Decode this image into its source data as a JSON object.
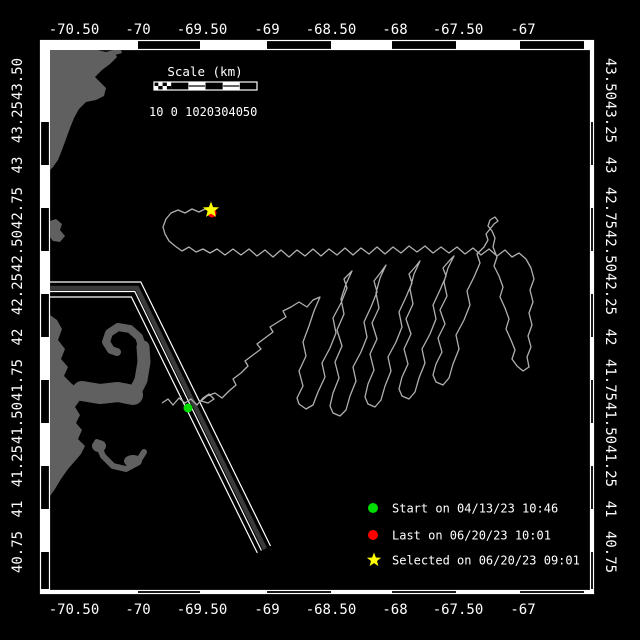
{
  "colors": {
    "background": "#000000",
    "frame": "#ffffff",
    "land": "#606060",
    "lane_fill": "#3a3a3a",
    "lane_edge": "#ffffff",
    "track": "#b0b0b0",
    "start": "#00dd00",
    "last": "#ff0000",
    "selected": "#ffff00"
  },
  "axes": {
    "top_labels": [
      {
        "t": "-70.50",
        "x": 74
      },
      {
        "t": "-70",
        "x": 138
      },
      {
        "t": "-69.50",
        "x": 202
      },
      {
        "t": "-69",
        "x": 267
      },
      {
        "t": "-68.50",
        "x": 331
      },
      {
        "t": "-68",
        "x": 395
      },
      {
        "t": "-67.50",
        "x": 458
      },
      {
        "t": "-67",
        "x": 523
      }
    ],
    "bottom_labels": [
      {
        "t": "-70.50",
        "x": 74
      },
      {
        "t": "-70",
        "x": 138
      },
      {
        "t": "-69.50",
        "x": 202
      },
      {
        "t": "-69",
        "x": 267
      },
      {
        "t": "-68.50",
        "x": 331
      },
      {
        "t": "-68",
        "x": 395
      },
      {
        "t": "-67.50",
        "x": 458
      },
      {
        "t": "-67",
        "x": 523
      }
    ],
    "left_labels": [
      {
        "t": "43.50",
        "y": 79
      },
      {
        "t": "43.25",
        "y": 122
      },
      {
        "t": "43",
        "y": 165
      },
      {
        "t": "42.75",
        "y": 208
      },
      {
        "t": "42.50",
        "y": 251
      },
      {
        "t": "42.25",
        "y": 294
      },
      {
        "t": "42",
        "y": 337
      },
      {
        "t": "41.75",
        "y": 380
      },
      {
        "t": "41.50",
        "y": 423
      },
      {
        "t": "41.25",
        "y": 466
      },
      {
        "t": "41",
        "y": 509
      },
      {
        "t": "40.75",
        "y": 552
      }
    ],
    "right_labels": [
      {
        "t": "43.50",
        "y": 79
      },
      {
        "t": "43.25",
        "y": 122
      },
      {
        "t": "43",
        "y": 165
      },
      {
        "t": "42.75",
        "y": 208
      },
      {
        "t": "42.50",
        "y": 251
      },
      {
        "t": "42.25",
        "y": 294
      },
      {
        "t": "42",
        "y": 337
      },
      {
        "t": "41.75",
        "y": 380
      },
      {
        "t": "41.50",
        "y": 423
      },
      {
        "t": "41.25",
        "y": 466
      },
      {
        "t": "41",
        "y": 509
      },
      {
        "t": "40.75",
        "y": 552
      }
    ],
    "lon_bars": [
      {
        "x": 138,
        "w": 62
      },
      {
        "x": 267,
        "w": 64
      },
      {
        "x": 392,
        "w": 64
      },
      {
        "x": 520,
        "w": 64
      }
    ],
    "lat_bars": [
      {
        "y": 122,
        "h": 43
      },
      {
        "y": 208,
        "h": 43
      },
      {
        "y": 294,
        "h": 43
      },
      {
        "y": 380,
        "h": 43
      },
      {
        "y": 466,
        "h": 43
      },
      {
        "y": 552,
        "h": 38
      }
    ]
  },
  "scalebar": {
    "title": "Scale (km)",
    "title_x": 205,
    "title_y": 76,
    "bar": {
      "x": 154,
      "y": 82,
      "w": 103,
      "h": 8
    },
    "segment_fills": [
      "checker",
      "black",
      "white",
      "black",
      "white",
      "black"
    ],
    "tick_labels": "10 0 1020304050",
    "labels_x": 149,
    "labels_y": 116
  },
  "legend": {
    "marker_x": 373,
    "text_x": 392,
    "items": [
      {
        "shape": "circle",
        "color": "#00dd00",
        "y": 508,
        "label": "Start on 04/13/23 10:46"
      },
      {
        "shape": "circle",
        "color": "#ff0000",
        "y": 535,
        "label": "Last on 06/20/23 10:01"
      },
      {
        "shape": "star",
        "color": "#ffff00",
        "y": 560,
        "label": "Selected on 06/20/23 09:01"
      }
    ]
  },
  "markers": {
    "start": {
      "x": 188,
      "y": 408,
      "r": 4.5
    },
    "last": {
      "x": 212,
      "y": 213,
      "r": 4.5
    },
    "selected": {
      "x": 211,
      "y": 210,
      "r": 8.5
    }
  },
  "land": {
    "polys": [
      [
        [
          50,
          50
        ],
        [
          97,
          50
        ],
        [
          106,
          52
        ],
        [
          113,
          50
        ],
        [
          117,
          57
        ],
        [
          110,
          64
        ],
        [
          102,
          70
        ],
        [
          95,
          77
        ],
        [
          100,
          82
        ],
        [
          106,
          88
        ],
        [
          104,
          96
        ],
        [
          96,
          100
        ],
        [
          86,
          102
        ],
        [
          79,
          109
        ],
        [
          74,
          118
        ],
        [
          70,
          128
        ],
        [
          66,
          139
        ],
        [
          62,
          150
        ],
        [
          58,
          160
        ],
        [
          53,
          167
        ],
        [
          50,
          170
        ]
      ],
      [
        [
          113,
          50
        ],
        [
          120,
          48
        ],
        [
          122,
          53
        ],
        [
          115,
          55
        ]
      ],
      [
        [
          50,
          221
        ],
        [
          56,
          219
        ],
        [
          62,
          224
        ],
        [
          60,
          230
        ],
        [
          65,
          236
        ],
        [
          60,
          242
        ],
        [
          53,
          241
        ],
        [
          50,
          237
        ]
      ],
      [
        [
          50,
          315
        ],
        [
          57,
          320
        ],
        [
          62,
          329
        ],
        [
          58,
          340
        ],
        [
          65,
          349
        ],
        [
          61,
          359
        ],
        [
          68,
          367
        ],
        [
          64,
          376
        ],
        [
          72,
          384
        ],
        [
          79,
          389
        ],
        [
          85,
          393
        ],
        [
          80,
          400
        ],
        [
          75,
          407
        ],
        [
          80,
          415
        ],
        [
          76,
          423
        ],
        [
          82,
          430
        ],
        [
          78,
          439
        ],
        [
          85,
          446
        ],
        [
          81,
          454
        ],
        [
          75,
          461
        ],
        [
          68,
          469
        ],
        [
          61,
          479
        ],
        [
          55,
          489
        ],
        [
          50,
          496
        ]
      ]
    ],
    "strokes": [
      {
        "pts": [
          [
            82,
            391
          ],
          [
            100,
            394
          ],
          [
            118,
            392
          ],
          [
            133,
            395
          ]
        ],
        "w": 20
      },
      {
        "pts": [
          [
            133,
            396
          ],
          [
            141,
            380
          ],
          [
            144,
            362
          ],
          [
            143,
            347
          ]
        ],
        "w": 13
      },
      {
        "pts": [
          [
            143,
            349
          ],
          [
            139,
            337
          ],
          [
            130,
            329
          ],
          [
            118,
            327
          ],
          [
            109,
            333
          ],
          [
            106,
            342
          ],
          [
            111,
            350
          ],
          [
            117,
            352
          ]
        ],
        "w": 8
      },
      {
        "pts": [
          [
            97,
            442
          ],
          [
            103,
            456
          ],
          [
            113,
            466
          ],
          [
            126,
            469
          ],
          [
            137,
            463
          ],
          [
            144,
            452
          ]
        ],
        "w": 6
      }
    ],
    "blobs": [
      {
        "cx": 99,
        "cy": 446,
        "rx": 7,
        "ry": 6
      },
      {
        "cx": 133,
        "cy": 461,
        "rx": 9,
        "ry": 6
      }
    ]
  },
  "lane": {
    "edge_a": [
      [
        50,
        282
      ],
      [
        140.8,
        282
      ],
      [
        270.5,
        546
      ]
    ],
    "center": [
      [
        50,
        288
      ],
      [
        137,
        288
      ],
      [
        265,
        549
      ]
    ],
    "mid_line": [
      [
        50,
        291.5
      ],
      [
        134.8,
        291.5
      ],
      [
        261.4,
        550.5
      ]
    ],
    "edge_b": [
      [
        50,
        297
      ],
      [
        131.4,
        297
      ],
      [
        257.3,
        552.9
      ]
    ],
    "band_width": 4.5
  },
  "track": {
    "pts": [
      [
        162,
        403
      ],
      [
        168,
        399
      ],
      [
        173,
        405
      ],
      [
        179,
        398
      ],
      [
        185,
        403
      ],
      [
        191,
        399
      ],
      [
        197,
        405
      ],
      [
        203,
        398
      ],
      [
        209,
        394
      ],
      [
        214,
        399
      ],
      [
        208,
        403
      ],
      [
        201,
        401
      ],
      [
        207,
        396
      ],
      [
        215,
        393
      ],
      [
        222,
        398
      ],
      [
        229,
        391
      ],
      [
        236,
        385
      ],
      [
        233,
        379
      ],
      [
        241,
        373
      ],
      [
        248,
        366
      ],
      [
        245,
        361
      ],
      [
        253,
        355
      ],
      [
        261,
        349
      ],
      [
        257,
        344
      ],
      [
        265,
        338
      ],
      [
        273,
        332
      ],
      [
        270,
        327
      ],
      [
        278,
        322
      ],
      [
        286,
        317
      ],
      [
        283,
        311
      ],
      [
        291,
        307
      ],
      [
        299,
        302
      ],
      [
        307,
        307
      ],
      [
        313,
        300
      ],
      [
        320,
        297
      ],
      [
        314,
        311
      ],
      [
        309,
        326
      ],
      [
        303,
        342
      ],
      [
        306,
        356
      ],
      [
        299,
        371
      ],
      [
        303,
        386
      ],
      [
        297,
        398
      ],
      [
        299,
        404
      ],
      [
        306,
        409
      ],
      [
        313,
        405
      ],
      [
        318,
        392
      ],
      [
        325,
        377
      ],
      [
        322,
        363
      ],
      [
        330,
        348
      ],
      [
        336,
        333
      ],
      [
        333,
        318
      ],
      [
        341,
        303
      ],
      [
        347,
        288
      ],
      [
        344,
        279
      ],
      [
        352,
        271
      ],
      [
        346,
        284
      ],
      [
        341,
        299
      ],
      [
        344,
        314
      ],
      [
        337,
        330
      ],
      [
        342,
        346
      ],
      [
        335,
        362
      ],
      [
        339,
        378
      ],
      [
        333,
        393
      ],
      [
        330,
        406
      ],
      [
        333,
        413
      ],
      [
        340,
        416
      ],
      [
        346,
        410
      ],
      [
        350,
        396
      ],
      [
        356,
        381
      ],
      [
        353,
        367
      ],
      [
        361,
        352
      ],
      [
        367,
        337
      ],
      [
        364,
        322
      ],
      [
        371,
        307
      ],
      [
        377,
        292
      ],
      [
        374,
        281
      ],
      [
        381,
        272
      ],
      [
        386,
        265
      ],
      [
        380,
        278
      ],
      [
        376,
        293
      ],
      [
        379,
        308
      ],
      [
        372,
        323
      ],
      [
        377,
        339
      ],
      [
        370,
        354
      ],
      [
        374,
        370
      ],
      [
        368,
        384
      ],
      [
        365,
        397
      ],
      [
        368,
        404
      ],
      [
        375,
        407
      ],
      [
        381,
        400
      ],
      [
        385,
        386
      ],
      [
        391,
        371
      ],
      [
        388,
        357
      ],
      [
        396,
        342
      ],
      [
        402,
        327
      ],
      [
        399,
        312
      ],
      [
        406,
        297
      ],
      [
        412,
        283
      ],
      [
        409,
        274
      ],
      [
        416,
        266
      ],
      [
        420,
        261
      ],
      [
        414,
        274
      ],
      [
        410,
        289
      ],
      [
        413,
        304
      ],
      [
        406,
        319
      ],
      [
        411,
        334
      ],
      [
        404,
        349
      ],
      [
        408,
        364
      ],
      [
        402,
        377
      ],
      [
        399,
        389
      ],
      [
        402,
        396
      ],
      [
        409,
        399
      ],
      [
        415,
        392
      ],
      [
        419,
        378
      ],
      [
        425,
        363
      ],
      [
        422,
        349
      ],
      [
        430,
        334
      ],
      [
        436,
        319
      ],
      [
        433,
        305
      ],
      [
        440,
        290
      ],
      [
        446,
        276
      ],
      [
        443,
        268
      ],
      [
        450,
        260
      ],
      [
        454,
        256
      ],
      [
        448,
        268
      ],
      [
        444,
        282
      ],
      [
        447,
        296
      ],
      [
        440,
        310
      ],
      [
        445,
        324
      ],
      [
        438,
        338
      ],
      [
        442,
        352
      ],
      [
        436,
        364
      ],
      [
        433,
        375
      ],
      [
        436,
        382
      ],
      [
        443,
        385
      ],
      [
        449,
        378
      ],
      [
        453,
        364
      ],
      [
        459,
        349
      ],
      [
        456,
        335
      ],
      [
        464,
        320
      ],
      [
        470,
        305
      ],
      [
        467,
        291
      ],
      [
        474,
        277
      ],
      [
        480,
        263
      ],
      [
        477,
        254
      ],
      [
        484,
        247
      ],
      [
        488,
        240
      ],
      [
        486,
        234
      ],
      [
        490,
        229
      ],
      [
        494,
        224
      ],
      [
        498,
        221
      ],
      [
        495,
        217
      ],
      [
        490,
        220
      ],
      [
        488,
        226
      ],
      [
        492,
        231
      ],
      [
        495,
        238
      ],
      [
        493,
        247
      ],
      [
        497,
        257
      ],
      [
        494,
        266
      ],
      [
        499,
        276
      ],
      [
        503,
        287
      ],
      [
        500,
        297
      ],
      [
        505,
        308
      ],
      [
        509,
        319
      ],
      [
        506,
        329
      ],
      [
        511,
        340
      ],
      [
        515,
        350
      ],
      [
        512,
        359
      ],
      [
        517,
        366
      ],
      [
        523,
        371
      ],
      [
        529,
        367
      ],
      [
        527,
        357
      ],
      [
        531,
        347
      ],
      [
        528,
        336
      ],
      [
        532,
        325
      ],
      [
        529,
        313
      ],
      [
        533,
        302
      ],
      [
        530,
        290
      ],
      [
        534,
        279
      ],
      [
        531,
        268
      ],
      [
        526,
        259
      ],
      [
        519,
        253
      ],
      [
        512,
        257
      ],
      [
        505,
        250
      ],
      [
        497,
        256
      ],
      [
        489,
        249
      ],
      [
        481,
        255
      ],
      [
        473,
        248
      ],
      [
        465,
        254
      ],
      [
        457,
        247
      ],
      [
        449,
        253
      ],
      [
        441,
        247
      ],
      [
        433,
        253
      ],
      [
        425,
        246
      ],
      [
        417,
        252
      ],
      [
        409,
        246
      ],
      [
        401,
        253
      ],
      [
        393,
        247
      ],
      [
        385,
        254
      ],
      [
        377,
        247
      ],
      [
        369,
        254
      ],
      [
        361,
        248
      ],
      [
        353,
        255
      ],
      [
        345,
        248
      ],
      [
        337,
        255
      ],
      [
        329,
        249
      ],
      [
        321,
        256
      ],
      [
        313,
        249
      ],
      [
        305,
        256
      ],
      [
        297,
        250
      ],
      [
        289,
        257
      ],
      [
        281,
        250
      ],
      [
        273,
        257
      ],
      [
        265,
        250
      ],
      [
        257,
        256
      ],
      [
        249,
        249
      ],
      [
        241,
        255
      ],
      [
        233,
        249
      ],
      [
        225,
        255
      ],
      [
        217,
        249
      ],
      [
        210,
        253
      ],
      [
        203,
        249
      ],
      [
        196,
        252
      ],
      [
        189,
        247
      ],
      [
        182,
        251
      ],
      [
        175,
        246
      ],
      [
        169,
        241
      ],
      [
        165,
        234
      ],
      [
        163,
        227
      ],
      [
        166,
        219
      ],
      [
        171,
        213
      ],
      [
        178,
        210
      ],
      [
        185,
        213
      ],
      [
        192,
        209
      ],
      [
        199,
        212
      ],
      [
        205,
        209
      ],
      [
        211,
        210
      ]
    ]
  }
}
